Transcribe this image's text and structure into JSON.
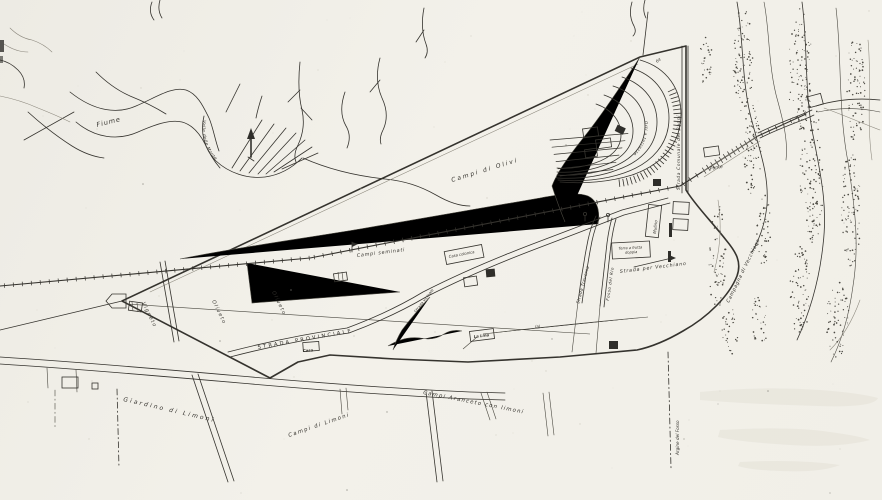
{
  "colors": {
    "paper": "#f2f0e9",
    "ink": "#35332e",
    "faint_ink": "#8b877c",
    "stipple": "#4c4a43"
  },
  "map": {
    "region_labels": {
      "fiume": "Fiume",
      "valle": "Valle delle Monte",
      "campi_olivi": "Campi di Olivi",
      "campi_seminati": "Campi seminati",
      "vigneto": "Vigneto",
      "oliveto_1": "Oliveto",
      "oliveto_2": "Oliveto",
      "orti_terrazze": "Orti a terrazze",
      "giardino_limoni": "Giardino di Limoni",
      "campi_limoni": "Campi di Limoni",
      "campi_aranceto": "Campi Aranceto con limoni",
      "terra_frutta_line1": "Terra a frutta",
      "terra_frutta_line2": "doppia",
      "campagna_vecchiano": "Campagna di Vecchiano"
    },
    "road_labels": {
      "strada_provinciale": "STRADA PROVINCIALE",
      "strada_vecchiano": "Strada per Vecchiano",
      "strada_comunale": "Strada Comunale dei Bagni",
      "strada_traversa": "Strada Traversa",
      "strada_vicinale": "Strada vicinale",
      "ponte": "Ponte"
    },
    "water_labels": {
      "fosso_rio": "Fosso del Rio",
      "argine": "Argine del Fosso"
    },
    "building_labels": {
      "mulino": "Mulino",
      "casa_colonica": "Casa colonica",
      "la_lina": "La Lina",
      "casa": "Casa"
    },
    "annotations": {
      "quota_64": "64",
      "nota_a": "(a)"
    },
    "symbols": {
      "north_arrow": "north-arrow-icon",
      "bridge": "bridge-icon",
      "railway": "railway-ties-icon",
      "tree_flag": "tree-pennant-icon"
    }
  }
}
